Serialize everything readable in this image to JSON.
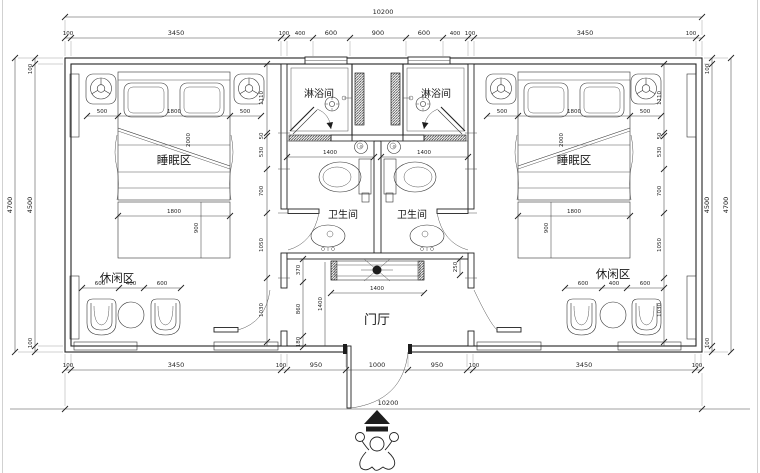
{
  "colors": {
    "line": "#222222",
    "dim": "#444444",
    "bg": "#ffffff"
  },
  "rooms": {
    "shower": "淋浴间",
    "toilet": "卫生间",
    "sleep": "睡眠区",
    "leisure": "休闲区",
    "hall": "门厅"
  },
  "dims": {
    "overall_w": "10200",
    "top_chain": [
      "100",
      "3450",
      "100",
      "400",
      "600",
      "900",
      "600",
      "400",
      "100",
      "3450",
      "100"
    ],
    "bottom_chain": [
      "100",
      "3450",
      "100",
      "950",
      "1000",
      "950",
      "100",
      "3450",
      "100"
    ],
    "side": {
      "outer": "4700",
      "inner": "4500",
      "cap": "100"
    },
    "room_chain": [
      "1110",
      "50",
      "530",
      "700",
      "1050",
      "1030"
    ],
    "bed": {
      "side": "500",
      "width": "1800",
      "length": "2000",
      "foot_w": "1800",
      "foot_d": "900"
    },
    "leisure_chain": [
      "600",
      "400",
      "600"
    ],
    "bath_width": "1400",
    "hall": {
      "counter_w": "1400",
      "depth": "1400",
      "seg_top": "370",
      "seg_mid": "860",
      "seg_bot": "180",
      "counter_d": "250"
    }
  }
}
